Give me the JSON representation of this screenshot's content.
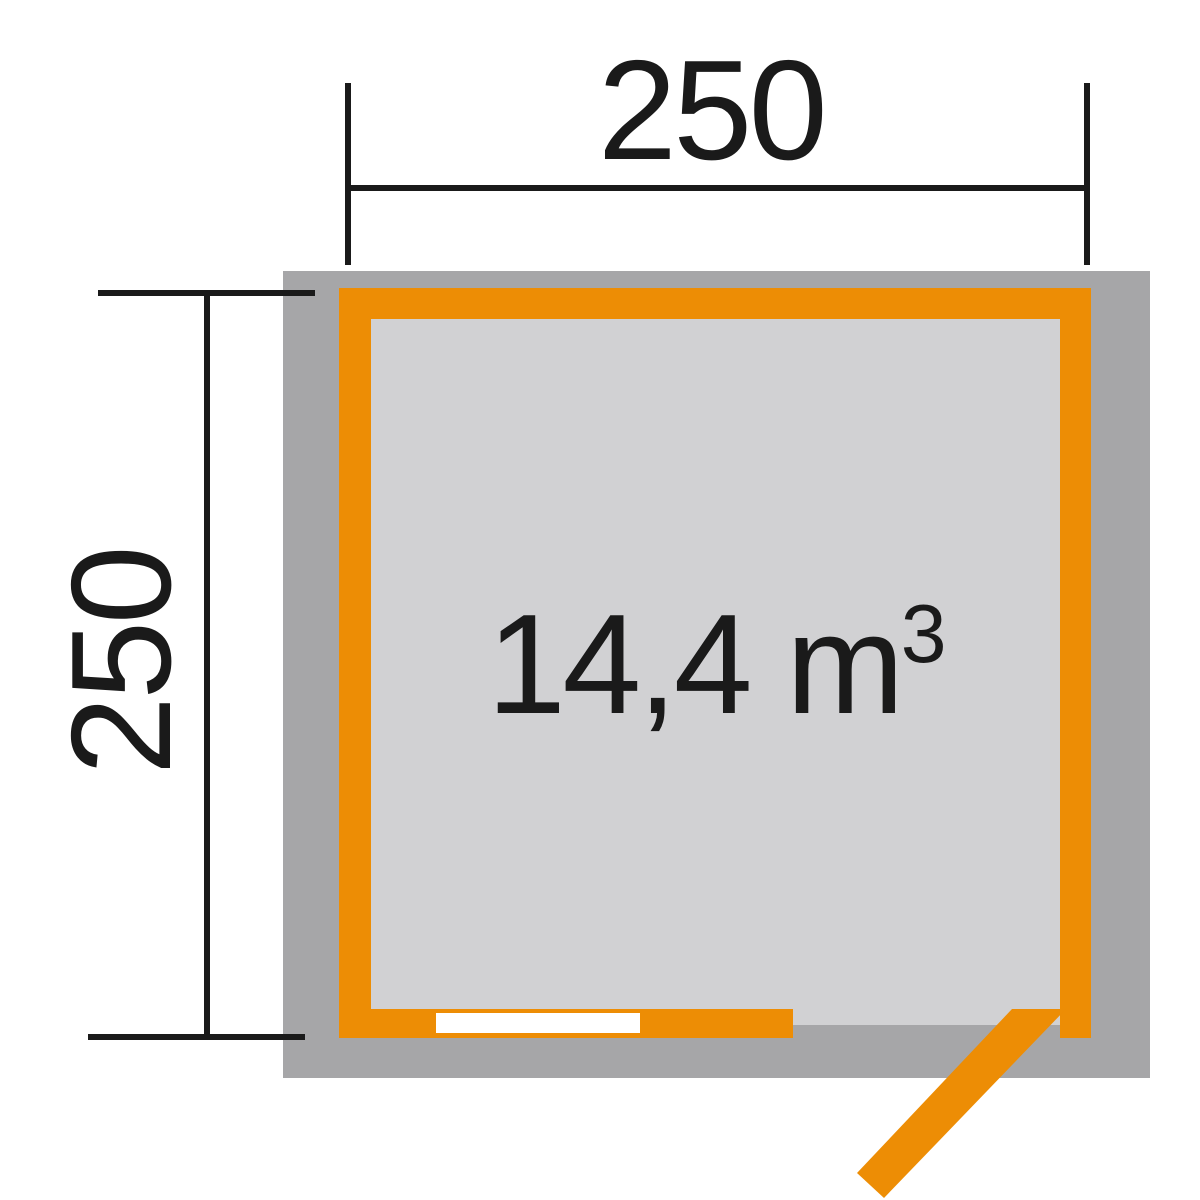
{
  "diagram": {
    "top_dimension": {
      "label": "250"
    },
    "left_dimension": {
      "label": "250"
    },
    "volume": {
      "value": "14,4",
      "unit": "m",
      "exponent": "3"
    }
  },
  "colors": {
    "wall_accent": "#ed8d05",
    "outer_wall_gray": "#a6a6a8",
    "floor_gray": "#d1d1d3",
    "window_white": "#ffffff",
    "line_black": "#1a1a1a"
  }
}
